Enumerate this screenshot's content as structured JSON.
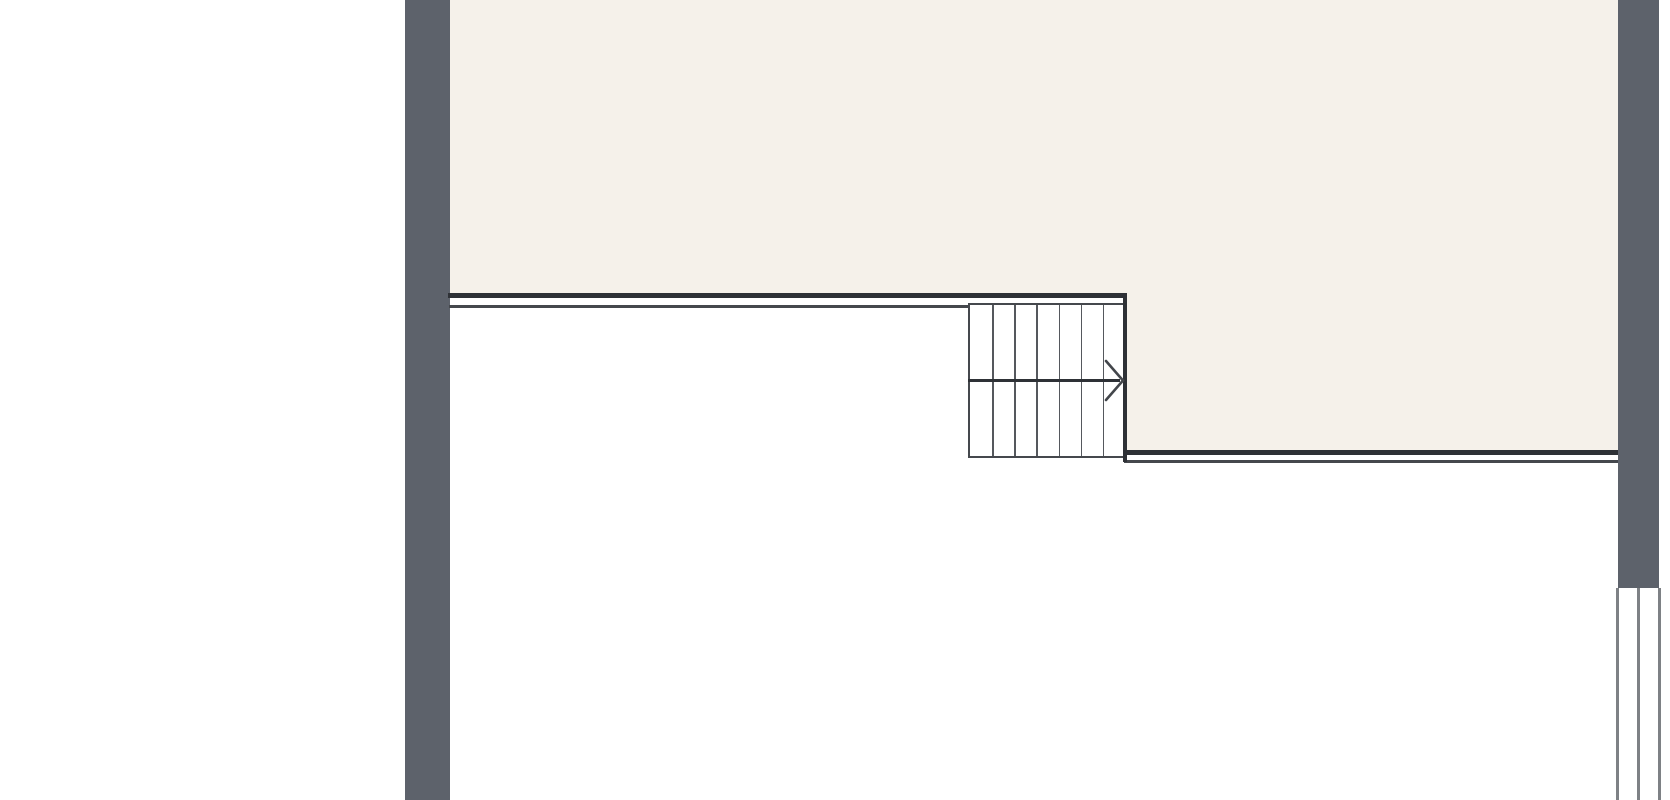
{
  "plan": {
    "type": "architectural-floor-plan",
    "visible_text": [],
    "colors": {
      "background_color": "#ffffff",
      "floor_color": "#f5f1ea",
      "wall_color": "#5d626b",
      "line_dark_color": "#2e3136",
      "line_medium_color": "#45484d",
      "tread_line_color": "#55585d",
      "window_line_color": "#7e8185"
    },
    "elements": {
      "left_wall": {
        "label": "left exterior wall"
      },
      "right_wall": {
        "label": "right exterior wall"
      },
      "upper_floor_area": {
        "label": "upper room floor"
      },
      "right_floor_area": {
        "label": "right room floor"
      },
      "upper_partition": {
        "label": "double edge line above stair landing"
      },
      "lower_partition": {
        "label": "double edge line right of stair"
      },
      "window": {
        "label": "window symbol in right wall",
        "pane_lines": 3
      },
      "staircase": {
        "label": "staircase",
        "tread_columns": 7,
        "walk_line": true,
        "direction_arrow": "right"
      }
    }
  }
}
